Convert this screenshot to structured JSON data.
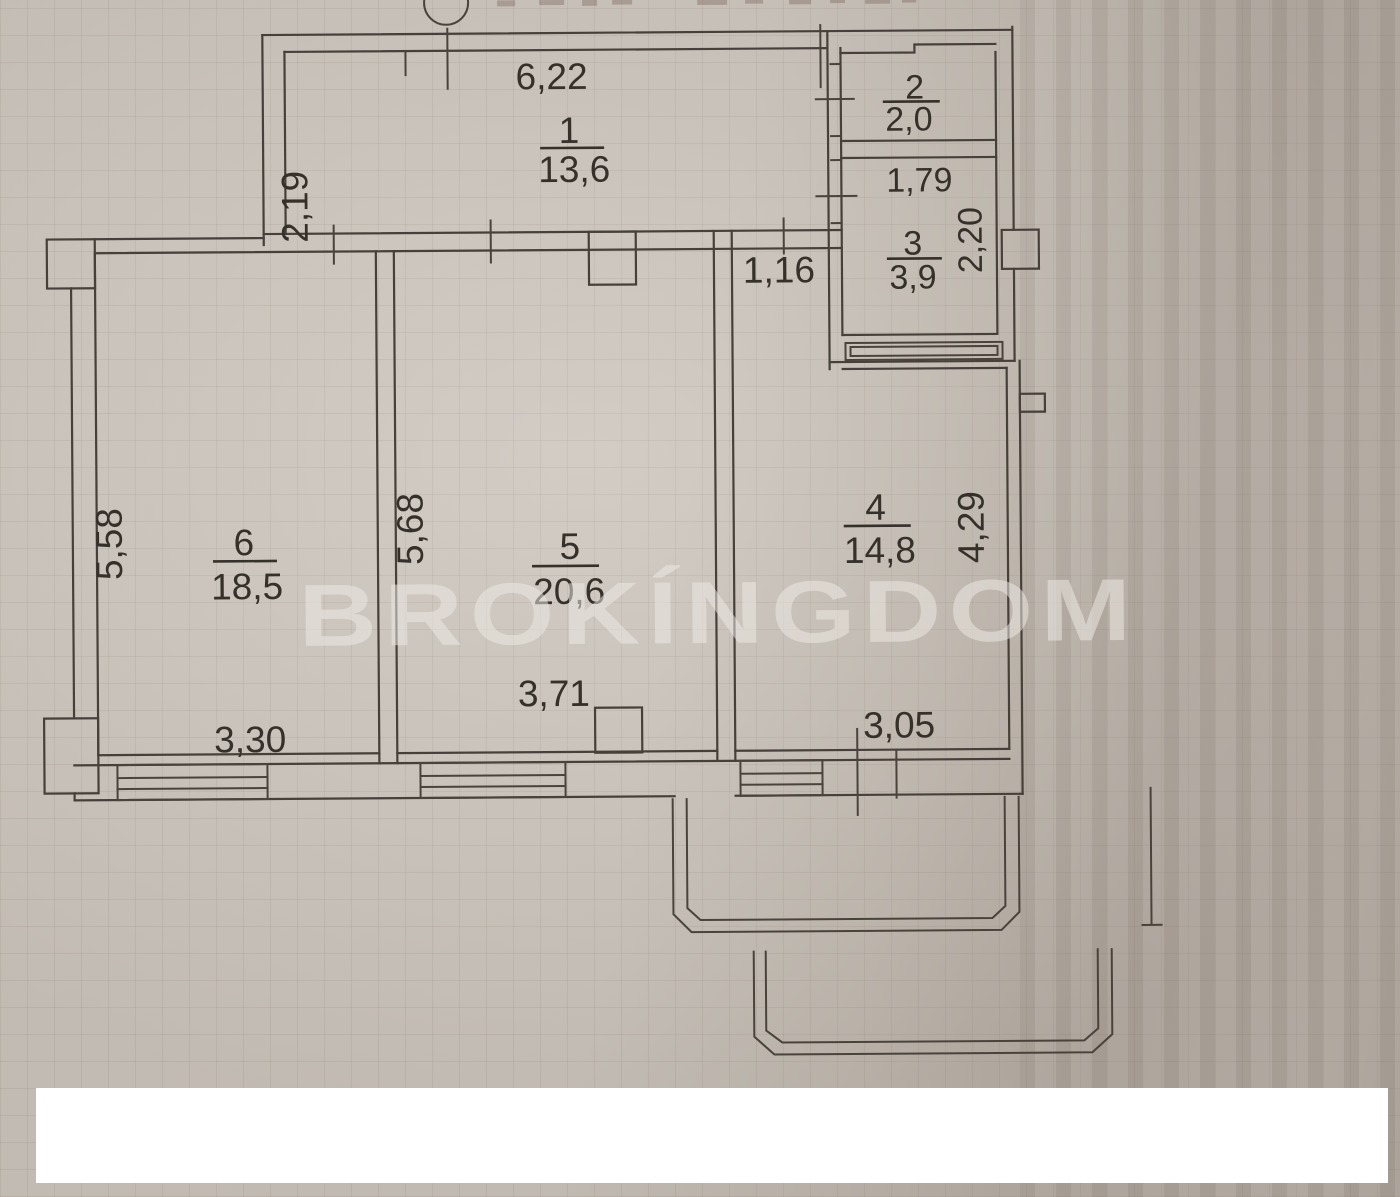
{
  "watermark": {
    "text": "BROKÍNGDOM"
  },
  "rooms": {
    "r1": {
      "number": "1",
      "area": "13,6",
      "dim_width": "6,22",
      "dim_height": "2,19"
    },
    "r2": {
      "number": "2",
      "area": "2,0"
    },
    "r3": {
      "number": "3",
      "area": "3,9",
      "dim_width": "1,79",
      "dim_height": "2,20"
    },
    "r4": {
      "number": "4",
      "area": "14,8",
      "dim_width": "3,05",
      "dim_height": "4,29",
      "dim_opening": "1,16"
    },
    "r5": {
      "number": "5",
      "area": "20,6",
      "dim_width": "3,71",
      "dim_height": "5,68"
    },
    "r6": {
      "number": "6",
      "area": "18,5",
      "dim_width": "3,30",
      "dim_height": "5,58"
    }
  }
}
